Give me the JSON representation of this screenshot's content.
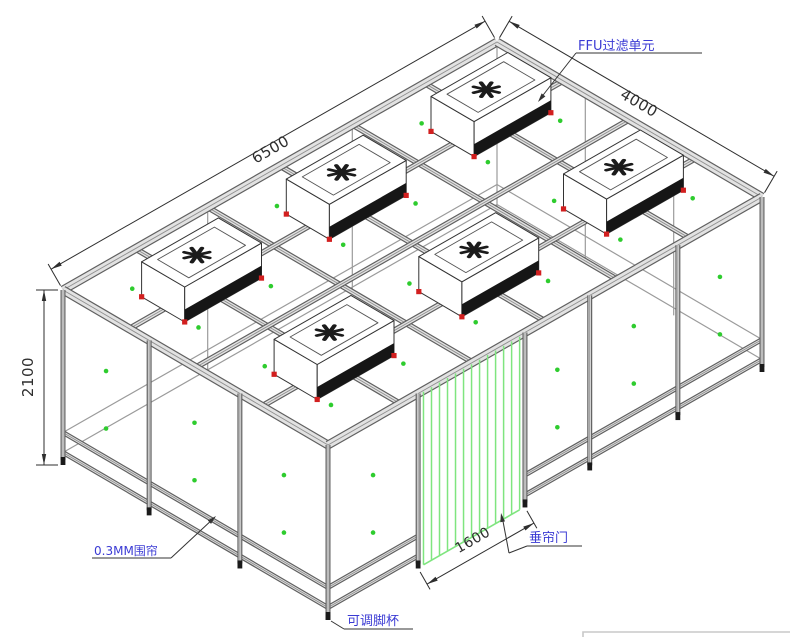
{
  "drawing": {
    "kind": "clean-booth-isometric-cad-drawing",
    "ffu_count": 6
  },
  "labels": {
    "ffu_unit": "FFU过滤单元",
    "curtain": "0.3MM围帘",
    "curtain_door": "垂帘门",
    "foot_cup": "可调脚杯"
  },
  "dimensions": {
    "length": "6500",
    "width": "4000",
    "height": "2100",
    "door_width": "1600"
  },
  "colors": {
    "line": "#333333",
    "beam_edge": "#606060",
    "beam_fill": "#e2e2e2",
    "beam_center": "#8f8f8f",
    "through_line": "#9b9b9b",
    "label_text": "#3b3bd4",
    "dim_text": "#2e2e2e",
    "leader": "#333333",
    "green_dot": "#2ecc2e",
    "curtain_green": "#7fe57f",
    "ffu_red": "#d21f1f",
    "ffu_band": "#161616",
    "fan": "#1b1b1b",
    "faint_border": "#c8c8c8",
    "background": "#ffffff"
  }
}
